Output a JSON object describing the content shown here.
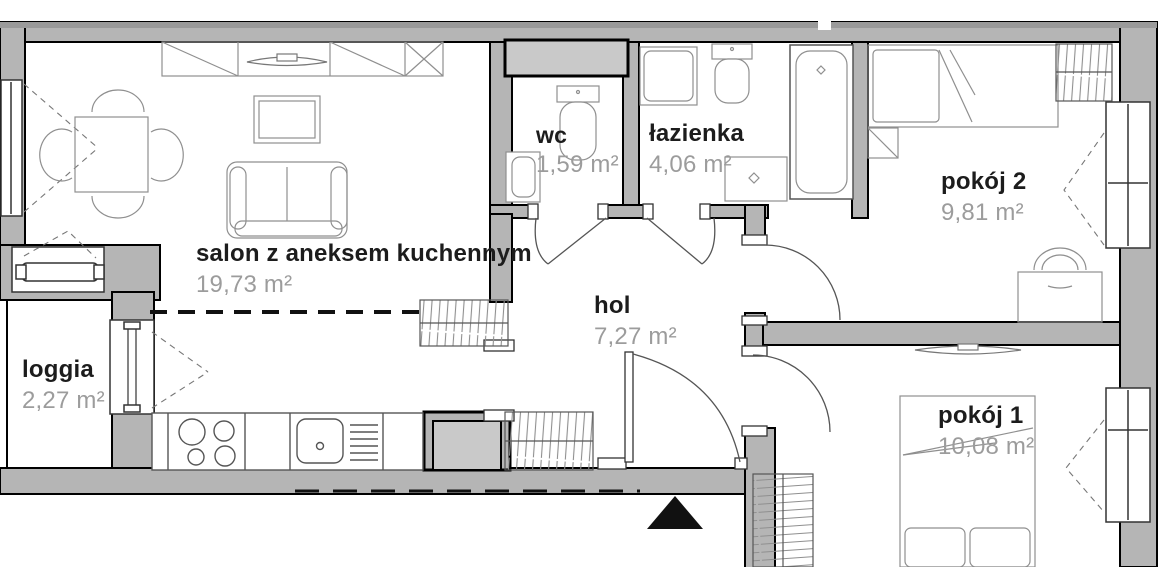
{
  "app": {
    "type": "apartment-floor-plan"
  },
  "colors": {
    "background": "#ffffff",
    "wall": "#b5b5b5",
    "wall_dark_strip": "#9a9a9a",
    "outline": "#000000",
    "room_name": "#1c1c1c",
    "room_area": "#9c9c9c",
    "furniture_line": "#8f8f8f",
    "entrance_arrow": "#111111"
  },
  "rooms": [
    {
      "id": "salon",
      "name": "salon z aneksem kuchennym",
      "area": "19,73 m²"
    },
    {
      "id": "loggia",
      "name": "loggia",
      "area": "2,27 m²"
    },
    {
      "id": "wc",
      "name": "wc",
      "area": "1,59 m²"
    },
    {
      "id": "lazienka",
      "name": "łazienka",
      "area": "4,06 m²"
    },
    {
      "id": "hol",
      "name": "hol",
      "area": "7,27 m²"
    },
    {
      "id": "pokoj2",
      "name": "pokój 2",
      "area": "9,81 m²"
    },
    {
      "id": "pokoj1",
      "name": "pokój 1",
      "area": "10,08 m²"
    }
  ],
  "symbols": [
    "entrance-arrow",
    "dining-table",
    "chair",
    "sofa",
    "tv-cabinet",
    "wall-cabinets",
    "radiator",
    "kitchen-counter",
    "cooktop",
    "kitchen-sink",
    "wardrobe",
    "washing-machine",
    "toilet",
    "washbasin",
    "bathtub",
    "bed-single",
    "bed-double",
    "desk",
    "desk-chair",
    "window",
    "balcony-door",
    "door-swing",
    "ventilation-shaft"
  ]
}
